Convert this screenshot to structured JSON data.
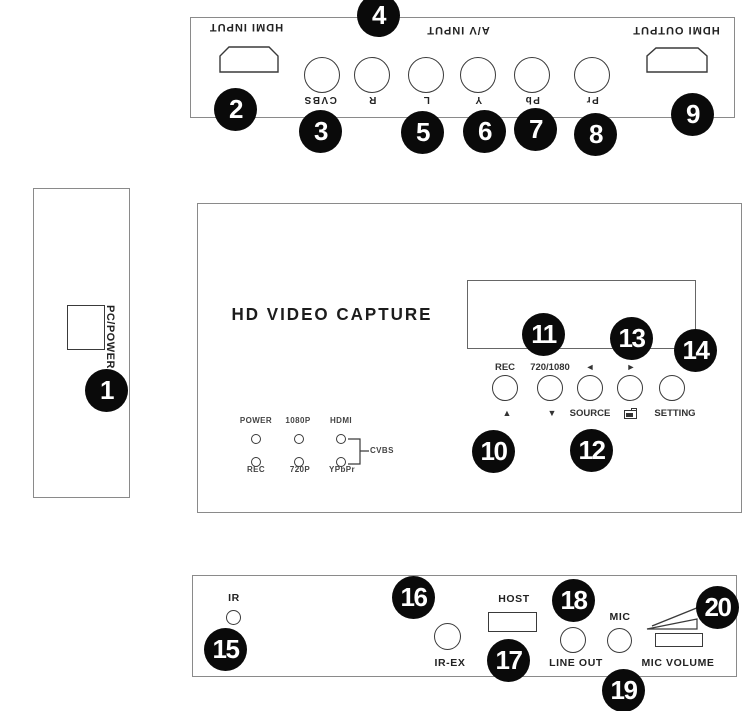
{
  "back_panel": {
    "hdmi_input": "HDMI INPUT",
    "av_input": "A/V INPUT",
    "hdmi_output": "HDMI OUTPUT",
    "jacks": [
      "CVBS",
      "R",
      "L",
      "Y",
      "Pb",
      "Pr"
    ]
  },
  "side_panel": {
    "port": "PC/POWER"
  },
  "front_panel": {
    "logo": "HD VIDEO CAPTURE",
    "led_labels_top": [
      "POWER",
      "1080P",
      "HDMI"
    ],
    "led_labels_bottom": [
      "REC",
      "720P",
      "YPbPr"
    ],
    "led_group_label": "CVBS",
    "button_labels_top": [
      "REC",
      "720/1080",
      "◄",
      "►"
    ],
    "button_labels_bottom": [
      "▲",
      "▼",
      "SOURCE",
      "SETTING"
    ]
  },
  "bottom_panel": {
    "ir": "IR",
    "ir_ex": "IR-EX",
    "host": "HOST",
    "line_out": "LINE OUT",
    "mic": "MIC",
    "mic_volume": "MIC VOLUME"
  },
  "callouts": [
    "1",
    "2",
    "3",
    "4",
    "5",
    "6",
    "7",
    "8",
    "9",
    "10",
    "11",
    "12",
    "13",
    "14",
    "15",
    "16",
    "17",
    "18",
    "19",
    "20"
  ],
  "colors": {
    "line": "#3a3a3a",
    "panel_border": "#8a8a8a",
    "callout_bg": "#0a0a0a",
    "callout_text": "#ffffff"
  }
}
